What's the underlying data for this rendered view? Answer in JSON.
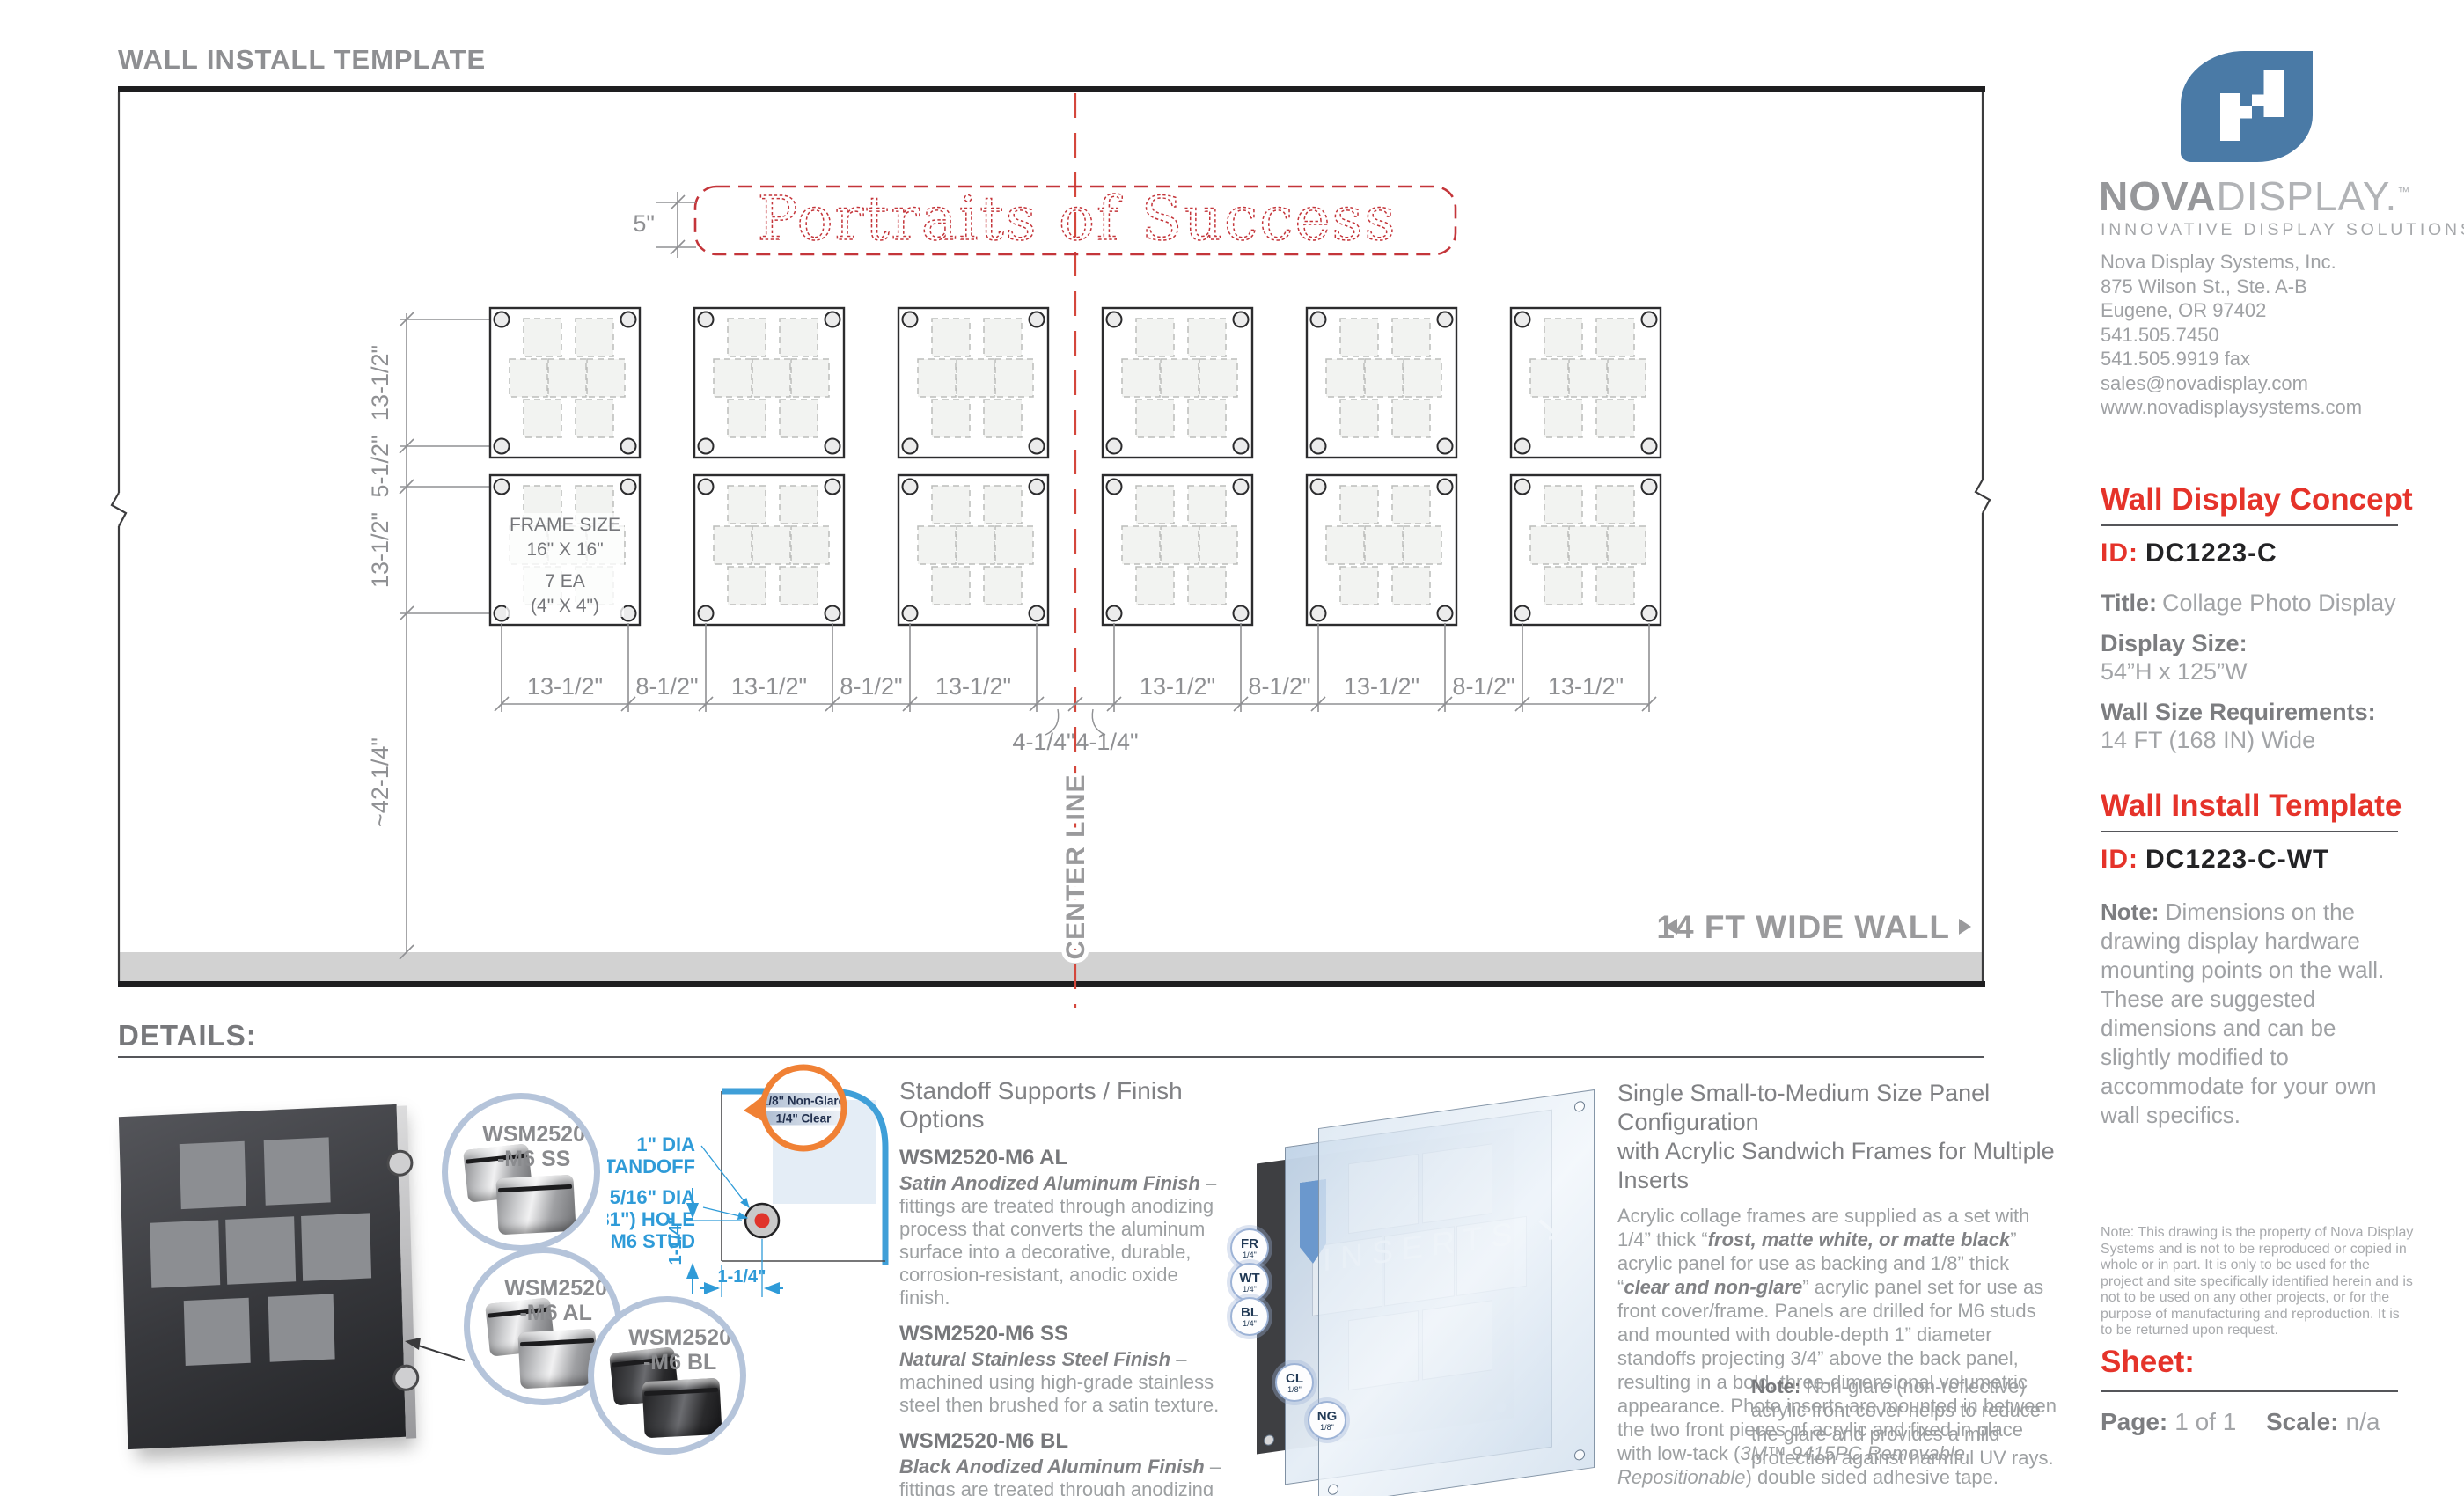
{
  "colors": {
    "accent_red": "#e5332a",
    "brand_blue": "#4a7aa6",
    "diagram_blue": "#2f9bd8",
    "magnifier_orange": "#f08135",
    "center_line_red": "#d4473c"
  },
  "page": {
    "title": "WALL INSTALL TEMPLATE",
    "details_heading": "DETAILS:"
  },
  "drawing": {
    "banner_text": "Portraits of Success",
    "banner_height": "5\"",
    "center_line_label": "CENTER LINE",
    "wall_width_label": "14 FT WIDE WALL",
    "frame_annotation": [
      "FRAME SIZE",
      "16\" X 16\"",
      "7 EA",
      "(4\" X 4\")"
    ],
    "left_dims": [
      "13-1/2\"",
      "5-1/2\"",
      "13-1/2\"",
      "~42-1/4\""
    ],
    "bottom_dims": {
      "frame_label": "13-1/2\"",
      "gap_label": "8-1/2\"",
      "center_label": "4-1/4\""
    }
  },
  "details": {
    "standoffs": {
      "title": "Standoff Supports / Finish Options",
      "items": [
        {
          "code": "WSM2520-M6 AL",
          "finish": "Satin Anodized Aluminum Finish",
          "desc": "– fittings are treated through anodizing process that converts the aluminum surface into a decorative, durable, corrosion-resistant, anodic oxide finish."
        },
        {
          "code": "WSM2520-M6 SS",
          "finish": "Natural Stainless Steel Finish",
          "desc": "– machined using high-grade stainless steel then brushed for a satin texture."
        },
        {
          "code": "WSM2520-M6 BL",
          "finish": "Black Anodized Aluminum Finish",
          "desc": "– fittings are treated through anodizing process and surface is coated with a black satin/matte finish."
        }
      ],
      "bubbles": [
        {
          "line1": "WSM2520",
          "line2": "-M6 SS"
        },
        {
          "line1": "WSM2520",
          "line2": "-M6 AL"
        },
        {
          "line1": "WSM2520",
          "line2": "-M6 BL"
        }
      ]
    },
    "corner": {
      "standoff_label": [
        "1\" DIA",
        "STANDOFF"
      ],
      "hole_label": [
        "5/16\" DIA",
        "(0.31\") HOLE",
        "M6 STUD"
      ],
      "dim_v": "1-1/4\"",
      "dim_h": "1-1/4\"",
      "layers": [
        "1/8\" Non-Glare",
        "1/4\" Clear"
      ]
    },
    "sandwich": {
      "title_line1": "Single Small-to-Medium Size Panel Configuration",
      "title_line2": "with Acrylic Sandwich Frames for Multiple Inserts",
      "body": [
        "Acrylic collage frames are supplied as a set with 1/4” thick “",
        "frost, matte white, or matte black",
        "” acrylic panel for use as backing and 1/8” thick “",
        "clear and non-glare",
        "” acrylic panel set for use as front cover/frame. Panels are drilled for M6 studs and  mounted with double-depth 1” diameter standoffs projecting 3/4” above the back panel, resulting in a bold, three-dimensional volumetric appearance. Photo inserts are mounted in between the two front pieces of acrylic and fixed in place with low-tack (",
        "3M™ 9415PC Removable Repositionable",
        ") double sided adhesive tape."
      ],
      "inserts_label": "INSERTS",
      "note_label": "Note:",
      "note": "Non-glare (non-reflective) acrylic front cover helps to reduce the glare and provides a mild protection against harmful UV rays.",
      "badges": [
        {
          "code": "FR",
          "size": "1/4\""
        },
        {
          "code": "WT",
          "size": "1/4\""
        },
        {
          "code": "BL",
          "size": "1/4\""
        },
        {
          "code": "CL",
          "size": "1/8\""
        },
        {
          "code": "NG",
          "size": "1/8\""
        }
      ]
    }
  },
  "sidebar": {
    "brand": {
      "bold": "NOVA",
      "light": "DISPLAY.",
      "tm": "™",
      "tagline": "INNOVATIVE DISPLAY SOLUTIONS"
    },
    "address_lines": [
      "Nova Display Systems, Inc.",
      "875 Wilson St., Ste. A-B",
      "Eugene, OR 97402",
      "541.505.7450",
      "541.505.9919 fax",
      "sales@novadisplay.com",
      "www.novadisplaysystems.com"
    ],
    "concept": {
      "heading": "Wall Display Concept",
      "id_label": "ID:",
      "id_value": "DC1223-C",
      "title_label": "Title:",
      "title_value": "Collage Photo Display",
      "size_label": "Display Size:",
      "size_value": "54”H x 125”W",
      "wall_label": "Wall Size Requirements:",
      "wall_value": "14 FT (168 IN) Wide"
    },
    "install": {
      "heading": "Wall Install Template",
      "id_label": "ID:",
      "id_value": "DC1223-C-WT",
      "note_label": "Note:",
      "note": "Dimensions on the drawing display hardware mounting points on the wall. These are suggested dimensions and can be slightly modified to accommodate for your own wall specifics."
    },
    "legal": "Note: This drawing is the property of Nova Display Systems and is not to be reproduced or copied in whole or in part. It is only to be used for the project and site specifically identified herein and is not to be used on any other projects, or for the purpose of manufacturing and reproduction. It is to be returned upon request.",
    "sheet": {
      "heading": "Sheet:",
      "page_label": "Page:",
      "page_value": "1 of 1",
      "scale_label": "Scale:",
      "scale_value": "n/a"
    }
  }
}
